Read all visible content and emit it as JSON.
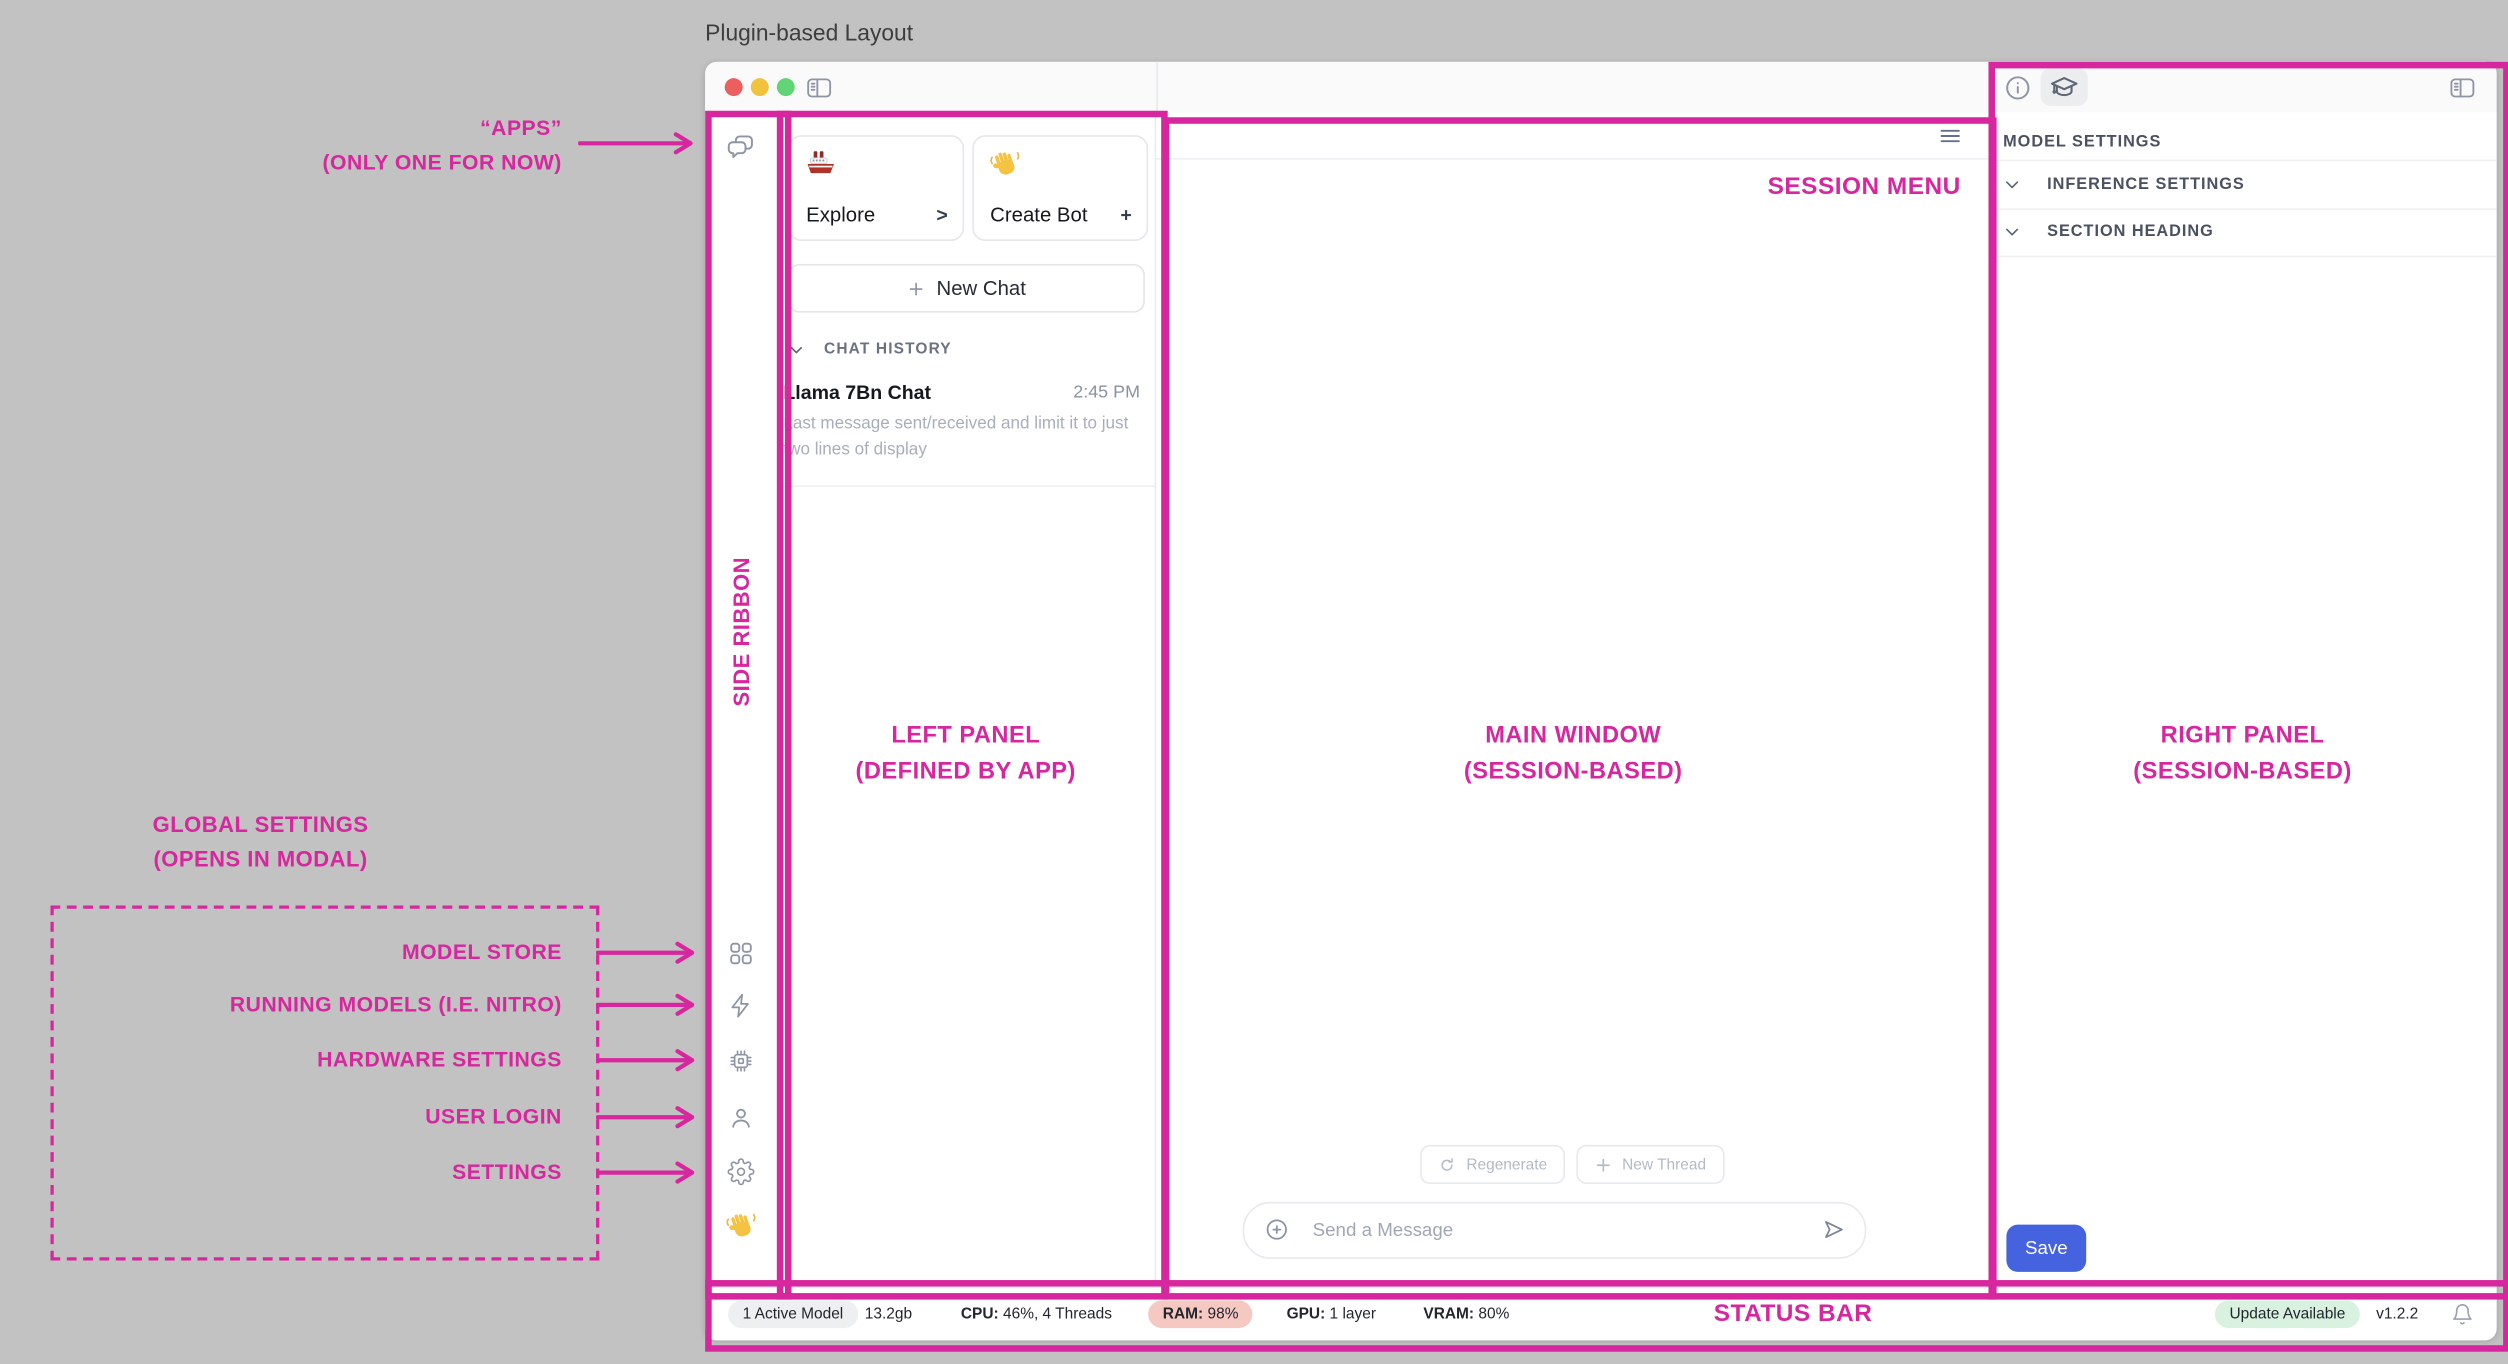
{
  "window_title": "Plugin-based Layout",
  "annotations": {
    "accent_color": "#D7279E",
    "apps_line1": "“APPS”",
    "apps_line2": "(ONLY ONE FOR NOW)",
    "side_ribbon": "SIDE RIBBON",
    "left_panel_line1": "LEFT PANEL",
    "left_panel_line2": "(DEFINED BY APP)",
    "main_window_line1": "MAIN WINDOW",
    "main_window_line2": "(SESSION-BASED)",
    "right_panel_line1": "RIGHT PANEL",
    "right_panel_line2": "(SESSION-BASED)",
    "session_menu": "SESSION MENU",
    "status_bar": "STATUS BAR",
    "global_line1": "GLOBAL SETTINGS",
    "global_line2": "(OPENS IN MODAL)",
    "global_items": [
      "MODEL STORE",
      "RUNNING MODELS (I.E. NITRO)",
      "HARDWARE SETTINGS",
      "USER LOGIN",
      "SETTINGS"
    ]
  },
  "left_panel": {
    "explore_label": "Explore",
    "explore_action": ">",
    "create_bot_label": "Create Bot",
    "create_bot_action": "+",
    "new_chat_label": "New Chat",
    "history_header": "CHAT HISTORY",
    "chat_title": "Llama 7Bn Chat",
    "chat_time": "2:45 PM",
    "chat_preview": "Last message sent/received and limit it to just two lines of display"
  },
  "main_window": {
    "regenerate_label": "Regenerate",
    "new_thread_label": "New Thread",
    "input_placeholder": "Send a Message"
  },
  "right_panel": {
    "section_header": "MODEL SETTINGS",
    "row1": "INFERENCE SETTINGS",
    "row2": "SECTION HEADING",
    "save_label": "Save"
  },
  "status_bar": {
    "active_models": "1 Active Model",
    "memory": "13.2gb",
    "cpu_label": "CPU:",
    "cpu_value": "46%, 4 Threads",
    "ram_label": "RAM:",
    "ram_value": "98%",
    "gpu_label": "GPU:",
    "gpu_value": "1 layer",
    "vram_label": "VRAM:",
    "vram_value": "80%",
    "update_label": "Update Available",
    "version": "v1.2.2"
  },
  "icons": {
    "ribbon": [
      "chat-bubbles-icon",
      "grid-icon",
      "zap-icon",
      "chip-icon",
      "user-icon",
      "gear-icon",
      "wave-hand-emoji"
    ],
    "titlebar": [
      "close-traffic-light",
      "minimize-traffic-light",
      "zoom-traffic-light",
      "sidebar-toggle-icon"
    ],
    "right_toolbar": [
      "info-icon",
      "graduation-cap-icon",
      "sidebar-toggle-icon"
    ],
    "other": [
      "hamburger-menu-icon",
      "chevron-down-icon",
      "refresh-icon",
      "plus-icon",
      "circle-plus-icon",
      "send-icon",
      "bell-icon",
      "ship-emoji"
    ]
  },
  "colors": {
    "annotation_pink": "#D7279E",
    "save_blue": "#4563DF",
    "ram_badge_bg": "#F5C8C1",
    "update_badge_bg": "#D9F2DF",
    "active_badge_bg": "#EEEFF1",
    "canvas_gray": "#C2C2C2"
  }
}
